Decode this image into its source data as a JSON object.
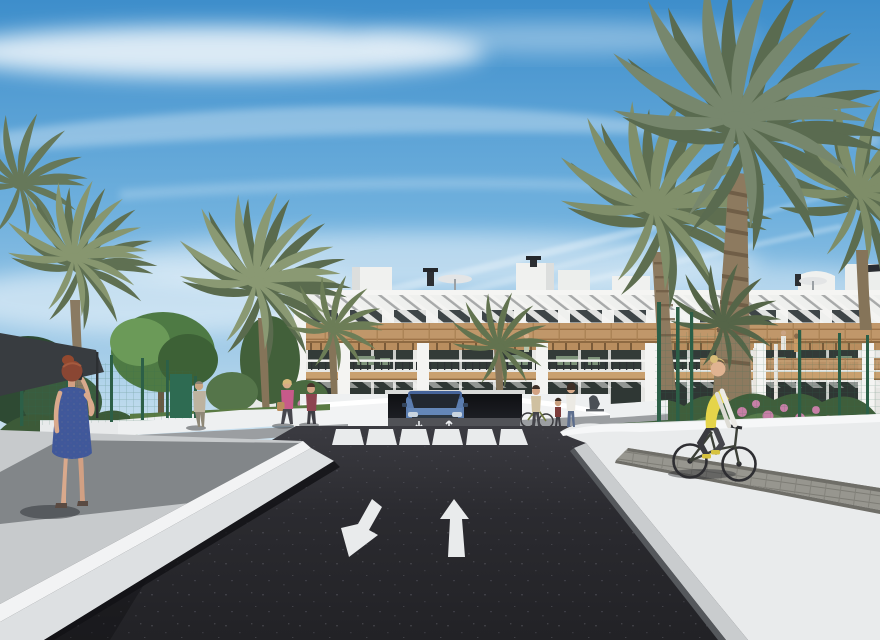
{
  "scene": {
    "type": "architectural-render",
    "label": "3D rendering of a modern white apartment complex with palm trees, an access road with garage ramp, crosswalk, pedestrians and a cyclist under a blue sky"
  },
  "palette": {
    "sky_top": "#3e8ecb",
    "sky_mid": "#8fc0e2",
    "sky_horizon": "#dcebf3",
    "cloud_white": "#ffffff",
    "road_asphalt": "#2b2b30",
    "road_shadow": "#1b1b1f",
    "sidewalk_gray": "#c7cacc",
    "walkway_white": "#e9ebec",
    "curb_white": "#f2f3f4",
    "wall_white": "#f0f1ef",
    "building_white": "#f2f2f0",
    "wood_band": "#c0976a",
    "glass_dark": "#333b38",
    "pergola_slat": "#5a5d60",
    "palm_green": "#7c8b68",
    "palm_green_dark": "#5f7052",
    "tree_green": "#4e7a44",
    "fence_green": "#2e6b52",
    "canopy_dark": "#383c40",
    "car_blue": "#5b7db0",
    "vest_yellow": "#e5d44a",
    "dress_blue": "#40589a",
    "hair_red": "#8a4633",
    "top_pink": "#c75a8a",
    "paver_gray": "#97968f",
    "flower_pink": "#c77fa6"
  },
  "objects": {
    "building": {
      "label": "two-storey white apartment block with wood bands, slatted pergolas, glazed terraces and rooftop boxes"
    },
    "garage": {
      "label": "underground garage ramp with blue SUV exiting"
    },
    "car": {
      "label": "blue SUV at garage ramp"
    },
    "road": {
      "label": "dark asphalt access road",
      "markings": {
        "crosswalk_stripes": 6,
        "left_lane_arrow": "down-left",
        "right_lane_arrow": "straight-ahead",
        "ramp_arrows": 2
      }
    },
    "left_walkway": {
      "label": "raised gray sidewalk with white curb"
    },
    "right_walkway": {
      "label": "sunlit white walkway with paver strip"
    },
    "fence": {
      "label": "green mesh garden fence"
    },
    "canopy": {
      "label": "dark shade sail at far left"
    },
    "people": [
      {
        "id": "woman-blue-dress",
        "label": "red-haired woman in blue dress on phone"
      },
      {
        "id": "man-beige",
        "label": "man in beige walking on path"
      },
      {
        "id": "woman-pink-top",
        "label": "blonde woman in pink top with handbag"
      },
      {
        "id": "woman-maroon-top",
        "label": "woman in maroon top"
      },
      {
        "id": "pedestrian-group",
        "label": "small group with bicycle and child near crosswalk"
      },
      {
        "id": "cyclist",
        "label": "cyclist with yellow hi-vis vest riding away"
      }
    ],
    "vegetation": {
      "palms": 9,
      "trees": "green garden trees",
      "bushes": "hedges with pink flowers"
    }
  }
}
